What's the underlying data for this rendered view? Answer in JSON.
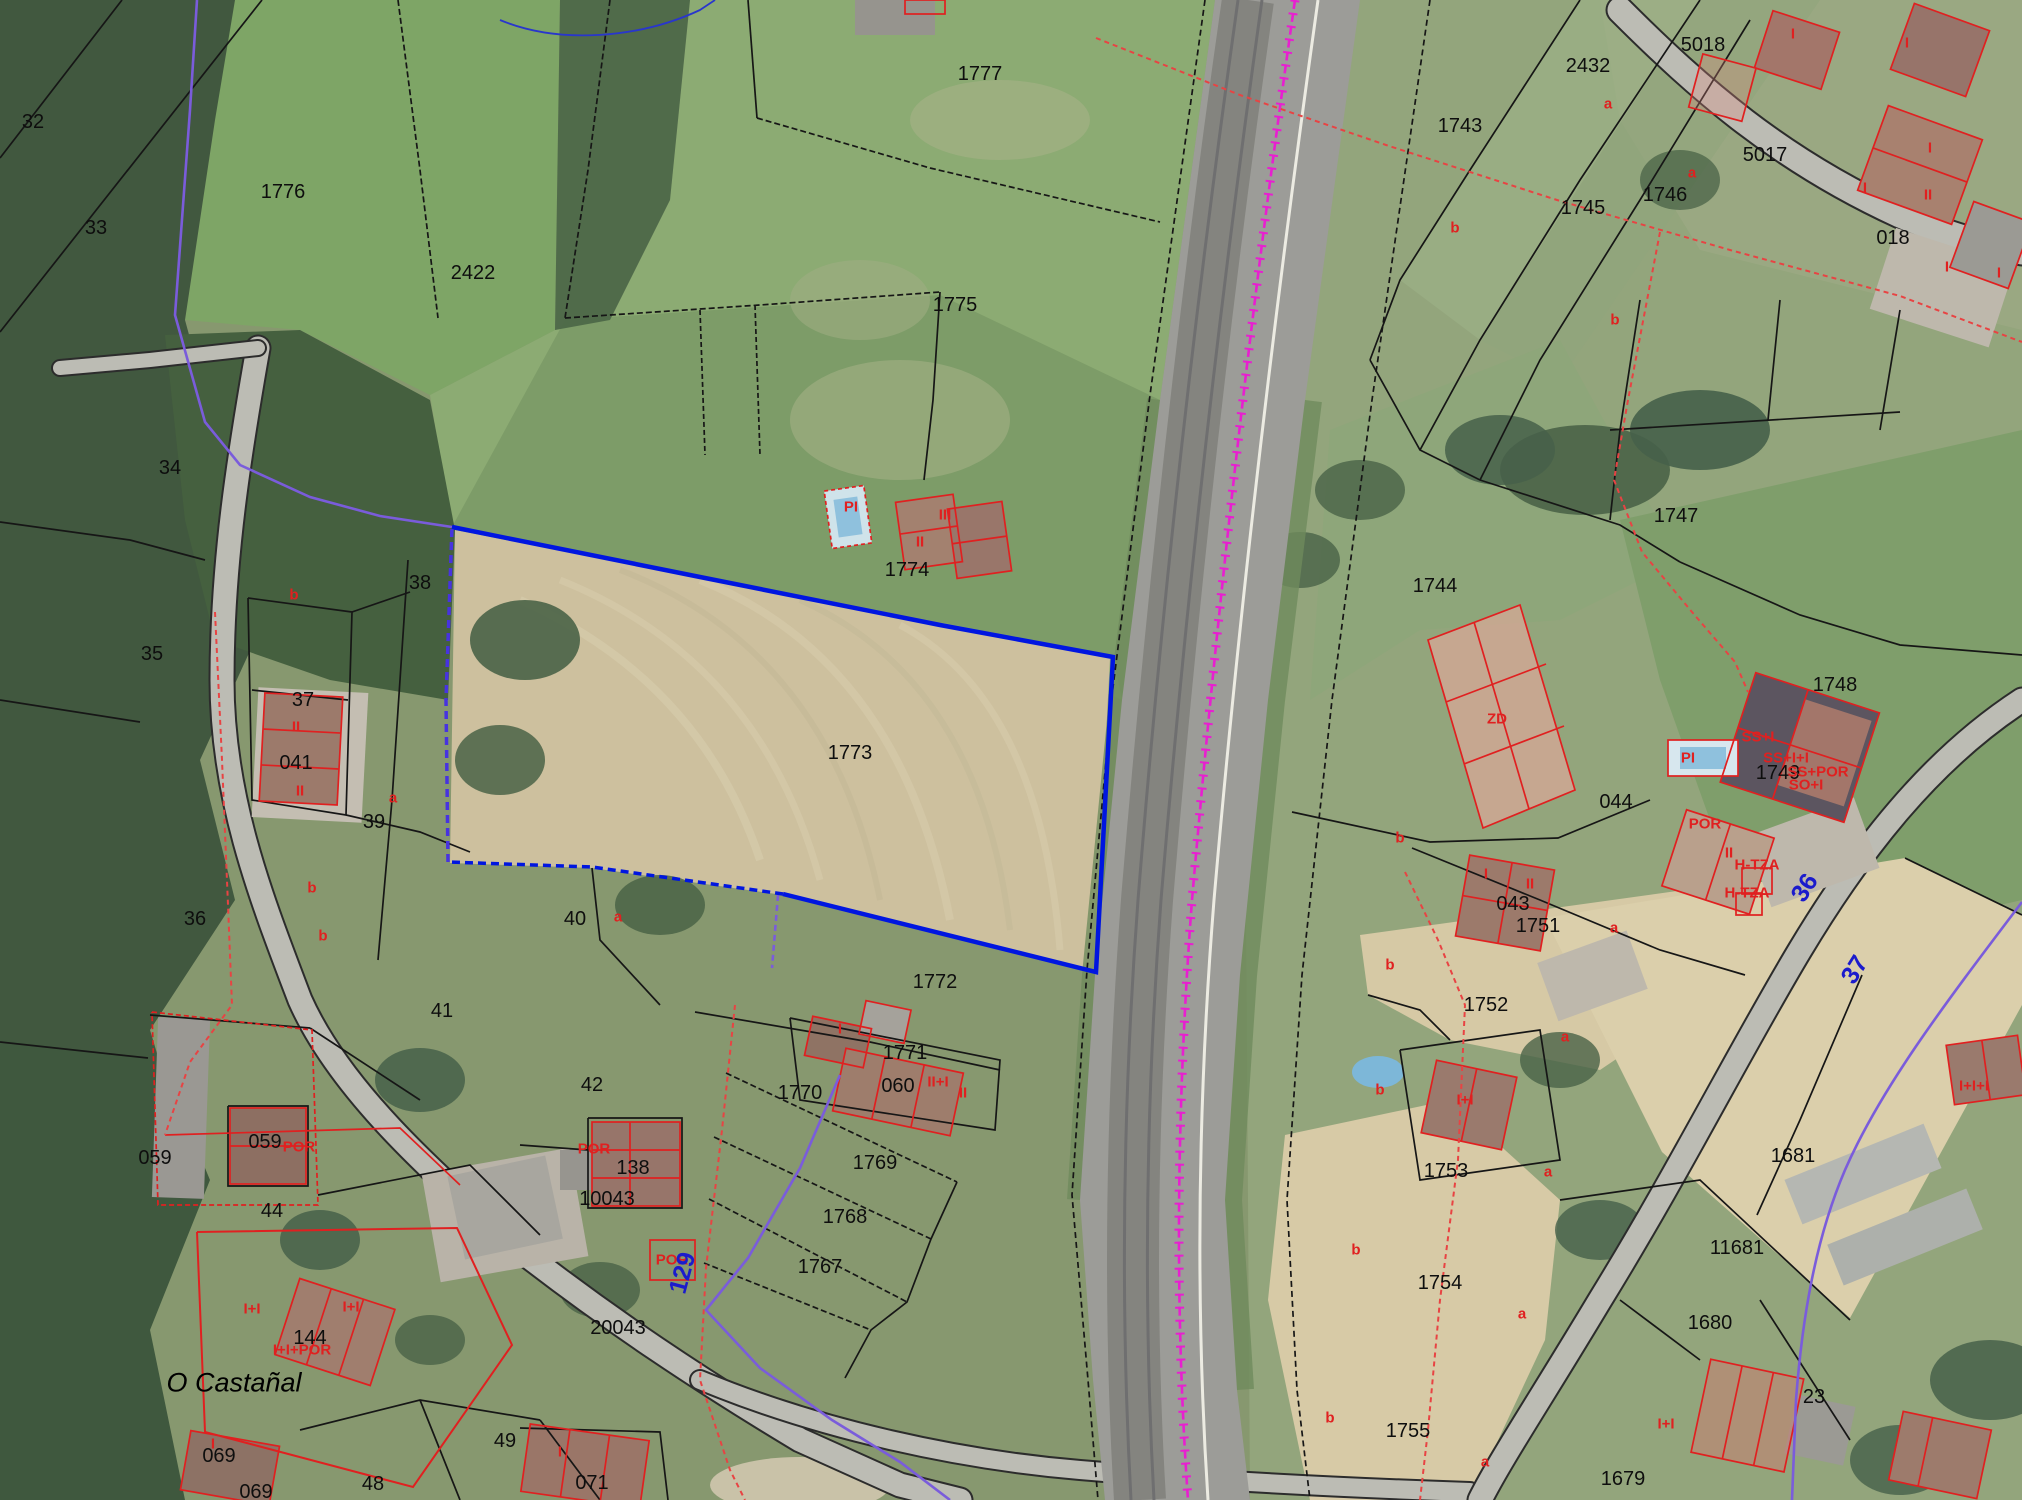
{
  "map": {
    "selected_parcel": {
      "id": "1773",
      "outline_color": "#0016e0"
    },
    "colors": {
      "boundary_black": "#161616",
      "building_red": "#e02020",
      "limit_red_dashed": "#e84343",
      "admin_purple": "#7a5cdb",
      "selection_blue": "#0016e0",
      "railway_magenta": "#e81fd0",
      "road_label_blue": "#1b1bcc"
    },
    "labels": [
      {
        "cls": "parcel",
        "text": "32",
        "x": 33,
        "y": 122
      },
      {
        "cls": "parcel",
        "text": "33",
        "x": 96,
        "y": 228
      },
      {
        "cls": "parcel",
        "text": "34",
        "x": 170,
        "y": 468
      },
      {
        "cls": "parcel",
        "text": "35",
        "x": 152,
        "y": 654
      },
      {
        "cls": "parcel",
        "text": "36",
        "x": 195,
        "y": 919
      },
      {
        "cls": "parcel",
        "text": "37",
        "x": 303,
        "y": 700
      },
      {
        "cls": "parcel",
        "text": "38",
        "x": 420,
        "y": 583
      },
      {
        "cls": "parcel",
        "text": "39",
        "x": 374,
        "y": 822
      },
      {
        "cls": "parcel",
        "text": "40",
        "x": 575,
        "y": 919
      },
      {
        "cls": "parcel",
        "text": "41",
        "x": 442,
        "y": 1011
      },
      {
        "cls": "parcel",
        "text": "42",
        "x": 592,
        "y": 1085
      },
      {
        "cls": "parcel",
        "text": "44",
        "x": 272,
        "y": 1211
      },
      {
        "cls": "parcel",
        "text": "48",
        "x": 373,
        "y": 1484
      },
      {
        "cls": "parcel",
        "text": "49",
        "x": 505,
        "y": 1441
      },
      {
        "cls": "parcel",
        "text": "1776",
        "x": 283,
        "y": 192
      },
      {
        "cls": "parcel",
        "text": "2422",
        "x": 473,
        "y": 273
      },
      {
        "cls": "parcel",
        "text": "1777",
        "x": 980,
        "y": 74
      },
      {
        "cls": "parcel",
        "text": "1775",
        "x": 955,
        "y": 305
      },
      {
        "cls": "parcel",
        "text": "1774",
        "x": 907,
        "y": 570
      },
      {
        "cls": "parcel",
        "text": "1773",
        "x": 850,
        "y": 753
      },
      {
        "cls": "parcel",
        "text": "1772",
        "x": 935,
        "y": 982
      },
      {
        "cls": "parcel",
        "text": "1771",
        "x": 905,
        "y": 1053
      },
      {
        "cls": "parcel",
        "text": "060",
        "x": 898,
        "y": 1086
      },
      {
        "cls": "parcel",
        "text": "1770",
        "x": 800,
        "y": 1093
      },
      {
        "cls": "parcel",
        "text": "1769",
        "x": 875,
        "y": 1163
      },
      {
        "cls": "parcel",
        "text": "1768",
        "x": 845,
        "y": 1217
      },
      {
        "cls": "parcel",
        "text": "1767",
        "x": 820,
        "y": 1267
      },
      {
        "cls": "parcel",
        "text": "059",
        "x": 265,
        "y": 1142
      },
      {
        "cls": "parcel",
        "text": "059",
        "x": 155,
        "y": 1158
      },
      {
        "cls": "parcel",
        "text": "041",
        "x": 296,
        "y": 763
      },
      {
        "cls": "parcel",
        "text": "069",
        "x": 219,
        "y": 1456
      },
      {
        "cls": "parcel",
        "text": "069",
        "x": 256,
        "y": 1492
      },
      {
        "cls": "parcel",
        "text": "071",
        "x": 592,
        "y": 1483
      },
      {
        "cls": "parcel",
        "text": "138",
        "x": 633,
        "y": 1168
      },
      {
        "cls": "parcel",
        "text": "10043",
        "x": 607,
        "y": 1199
      },
      {
        "cls": "parcel",
        "text": "20043",
        "x": 618,
        "y": 1328
      },
      {
        "cls": "parcel",
        "text": "144",
        "x": 310,
        "y": 1338
      },
      {
        "cls": "parcel",
        "text": "2432",
        "x": 1588,
        "y": 66
      },
      {
        "cls": "parcel",
        "text": "5018",
        "x": 1703,
        "y": 45
      },
      {
        "cls": "parcel",
        "text": "5017",
        "x": 1765,
        "y": 155
      },
      {
        "cls": "parcel",
        "text": "1743",
        "x": 1460,
        "y": 126
      },
      {
        "cls": "parcel",
        "text": "1745",
        "x": 1583,
        "y": 208
      },
      {
        "cls": "parcel",
        "text": "1746",
        "x": 1665,
        "y": 195
      },
      {
        "cls": "parcel",
        "text": "018",
        "x": 1893,
        "y": 238
      },
      {
        "cls": "parcel",
        "text": "1744",
        "x": 1435,
        "y": 586
      },
      {
        "cls": "parcel",
        "text": "1747",
        "x": 1676,
        "y": 516
      },
      {
        "cls": "parcel",
        "text": "1748",
        "x": 1835,
        "y": 685
      },
      {
        "cls": "parcel",
        "text": "1749",
        "x": 1778,
        "y": 773
      },
      {
        "cls": "parcel",
        "text": "044",
        "x": 1616,
        "y": 802
      },
      {
        "cls": "parcel",
        "text": "043",
        "x": 1513,
        "y": 904
      },
      {
        "cls": "parcel",
        "text": "1751",
        "x": 1538,
        "y": 926
      },
      {
        "cls": "parcel",
        "text": "1752",
        "x": 1486,
        "y": 1005
      },
      {
        "cls": "parcel",
        "text": "1753",
        "x": 1446,
        "y": 1171
      },
      {
        "cls": "parcel",
        "text": "1754",
        "x": 1440,
        "y": 1283
      },
      {
        "cls": "parcel",
        "text": "1755",
        "x": 1408,
        "y": 1431
      },
      {
        "cls": "parcel",
        "text": "1681",
        "x": 1793,
        "y": 1156
      },
      {
        "cls": "parcel",
        "text": "11681",
        "x": 1737,
        "y": 1248
      },
      {
        "cls": "parcel",
        "text": "1680",
        "x": 1710,
        "y": 1323
      },
      {
        "cls": "parcel",
        "text": "1679",
        "x": 1623,
        "y": 1479
      },
      {
        "cls": "parcel",
        "text": "23",
        "x": 1814,
        "y": 1397
      },
      {
        "cls": "red",
        "text": "a",
        "x": 1608,
        "y": 104
      },
      {
        "cls": "red",
        "text": "a",
        "x": 1692,
        "y": 173
      },
      {
        "cls": "red",
        "text": "b",
        "x": 1455,
        "y": 228
      },
      {
        "cls": "red",
        "text": "b",
        "x": 1615,
        "y": 320
      },
      {
        "cls": "red",
        "text": "b",
        "x": 294,
        "y": 595
      },
      {
        "cls": "red",
        "text": "a",
        "x": 393,
        "y": 798
      },
      {
        "cls": "red",
        "text": "b",
        "x": 312,
        "y": 888
      },
      {
        "cls": "red",
        "text": "b",
        "x": 323,
        "y": 936
      },
      {
        "cls": "red",
        "text": "a",
        "x": 618,
        "y": 917
      },
      {
        "cls": "red",
        "text": "b",
        "x": 1400,
        "y": 838
      },
      {
        "cls": "red",
        "text": "b",
        "x": 1390,
        "y": 965
      },
      {
        "cls": "red",
        "text": "b",
        "x": 1380,
        "y": 1090
      },
      {
        "cls": "red",
        "text": "b",
        "x": 1356,
        "y": 1250
      },
      {
        "cls": "red",
        "text": "b",
        "x": 1330,
        "y": 1418
      },
      {
        "cls": "red",
        "text": "a",
        "x": 1565,
        "y": 1037
      },
      {
        "cls": "red",
        "text": "a",
        "x": 1548,
        "y": 1172
      },
      {
        "cls": "red",
        "text": "a",
        "x": 1522,
        "y": 1314
      },
      {
        "cls": "red",
        "text": "a",
        "x": 1485,
        "y": 1462
      },
      {
        "cls": "red",
        "text": "a",
        "x": 1614,
        "y": 928
      },
      {
        "cls": "red",
        "text": "II",
        "x": 296,
        "y": 727
      },
      {
        "cls": "red",
        "text": "II",
        "x": 300,
        "y": 791
      },
      {
        "cls": "red",
        "text": "POR",
        "x": 299,
        "y": 1147
      },
      {
        "cls": "red",
        "text": "POR",
        "x": 594,
        "y": 1149
      },
      {
        "cls": "red",
        "text": "POR",
        "x": 672,
        "y": 1260
      },
      {
        "cls": "red",
        "text": "I+I",
        "x": 252,
        "y": 1309
      },
      {
        "cls": "red",
        "text": "I+I",
        "x": 351,
        "y": 1307
      },
      {
        "cls": "red",
        "text": "I+I+POR",
        "x": 302,
        "y": 1350
      },
      {
        "cls": "red",
        "text": "I",
        "x": 560,
        "y": 1452
      },
      {
        "cls": "red",
        "text": "I",
        "x": 213,
        "y": 1444
      },
      {
        "cls": "red",
        "text": "I",
        "x": 840,
        "y": 1029
      },
      {
        "cls": "red",
        "text": "II+I",
        "x": 938,
        "y": 1082
      },
      {
        "cls": "red",
        "text": "II",
        "x": 963,
        "y": 1093
      },
      {
        "cls": "red",
        "text": "II",
        "x": 920,
        "y": 542
      },
      {
        "cls": "red",
        "text": "III",
        "x": 945,
        "y": 515
      },
      {
        "cls": "red",
        "text": "PI",
        "x": 851,
        "y": 507
      },
      {
        "cls": "red",
        "text": "PI",
        "x": 1688,
        "y": 758
      },
      {
        "cls": "red",
        "text": "ZD",
        "x": 1497,
        "y": 719
      },
      {
        "cls": "red",
        "text": "SS+I",
        "x": 1758,
        "y": 737
      },
      {
        "cls": "red",
        "text": "SS+I+I",
        "x": 1786,
        "y": 758
      },
      {
        "cls": "red",
        "text": "SS+POR",
        "x": 1818,
        "y": 772
      },
      {
        "cls": "red",
        "text": "SO+I",
        "x": 1806,
        "y": 785
      },
      {
        "cls": "red",
        "text": "POR",
        "x": 1705,
        "y": 824
      },
      {
        "cls": "red",
        "text": "II",
        "x": 1729,
        "y": 853
      },
      {
        "cls": "red",
        "text": "H-TZA",
        "x": 1757,
        "y": 865
      },
      {
        "cls": "red",
        "text": "H-TZA",
        "x": 1747,
        "y": 893
      },
      {
        "cls": "red",
        "text": "I",
        "x": 1486,
        "y": 874
      },
      {
        "cls": "red",
        "text": "II",
        "x": 1530,
        "y": 884
      },
      {
        "cls": "red",
        "text": "I+I",
        "x": 1465,
        "y": 1100
      },
      {
        "cls": "red",
        "text": "I+I",
        "x": 1666,
        "y": 1424
      },
      {
        "cls": "red",
        "text": "I",
        "x": 1793,
        "y": 34
      },
      {
        "cls": "red",
        "text": "I",
        "x": 1907,
        "y": 43
      },
      {
        "cls": "red",
        "text": "I",
        "x": 1930,
        "y": 148
      },
      {
        "cls": "red",
        "text": "I",
        "x": 1865,
        "y": 188
      },
      {
        "cls": "red",
        "text": "II",
        "x": 1928,
        "y": 195
      },
      {
        "cls": "red",
        "text": "I",
        "x": 1947,
        "y": 267
      },
      {
        "cls": "red",
        "text": "I",
        "x": 1999,
        "y": 273
      },
      {
        "cls": "red",
        "text": "I+I+I",
        "x": 1974,
        "y": 1086
      },
      {
        "cls": "road",
        "text": "129",
        "x": 683,
        "y": 1273,
        "rot": -75
      },
      {
        "cls": "road",
        "text": "36",
        "x": 1805,
        "y": 888,
        "rot": -58
      },
      {
        "cls": "road",
        "text": "37",
        "x": 1855,
        "y": 970,
        "rot": -58
      },
      {
        "cls": "place",
        "text": "O Castañal",
        "x": 234,
        "y": 1383
      }
    ]
  }
}
